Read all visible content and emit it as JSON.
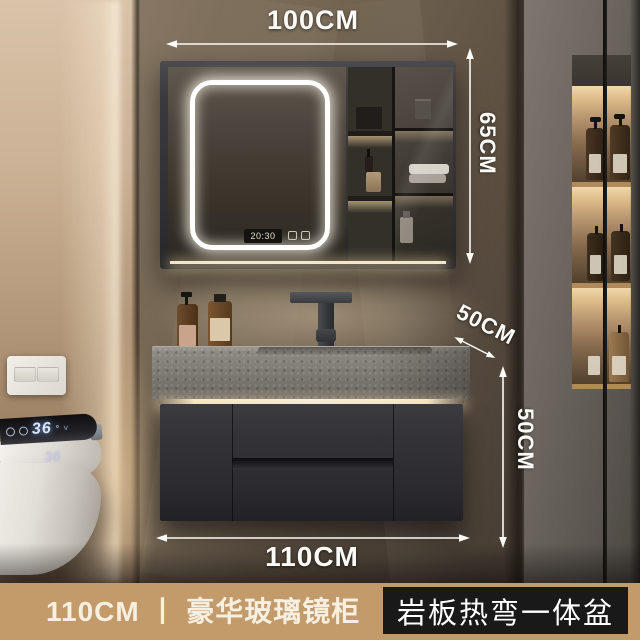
{
  "annotations": {
    "top_width": "100CM",
    "mirror_height": "65CM",
    "counter_depth": "50CM",
    "cabinet_height": "50CM",
    "bottom_width": "110CM",
    "color": "#fafaf7"
  },
  "mirror_cabinet": {
    "clock_time": "20:30"
  },
  "smart_toilet": {
    "temperature": "36",
    "degree": "°",
    "chevron": "˅"
  },
  "banner": {
    "size_and_name": "110CM 丨 豪华玻璃镜柜",
    "feature_tag": "岩板热弯一体盆",
    "background": "#c39a6a",
    "tag_background": "#191919",
    "text_color": "#f7efdf"
  }
}
